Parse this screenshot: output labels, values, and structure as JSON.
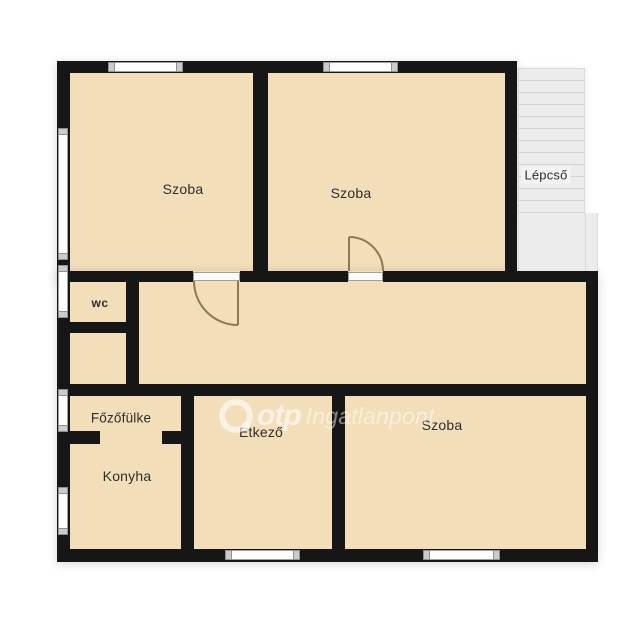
{
  "floorplan": {
    "rooms": [
      {
        "id": "szoba-top-left",
        "label": "Szoba"
      },
      {
        "id": "szoba-top-middle",
        "label": "Szoba"
      },
      {
        "id": "lepcso",
        "label": "Lépcső"
      },
      {
        "id": "wc",
        "label": "wc"
      },
      {
        "id": "fozofulke",
        "label": "Főzőfülke"
      },
      {
        "id": "konyha",
        "label": "Konyha"
      },
      {
        "id": "etkezo",
        "label": "Étkező"
      },
      {
        "id": "szoba-bottom-right",
        "label": "Szoba"
      }
    ],
    "watermark": {
      "brand": "otp",
      "name": "Ingatlanpont"
    },
    "colors": {
      "room_fill": "#f3deba",
      "wall": "#161616",
      "stairs_fill": "#ececec",
      "stair_line": "#d2d2d2",
      "window_fill": "#fdfdfd",
      "window_border": "#9e9e9e",
      "door_arc": "#8d7a52",
      "label_text": "#2e2e2e",
      "background": "#ffffff"
    }
  }
}
